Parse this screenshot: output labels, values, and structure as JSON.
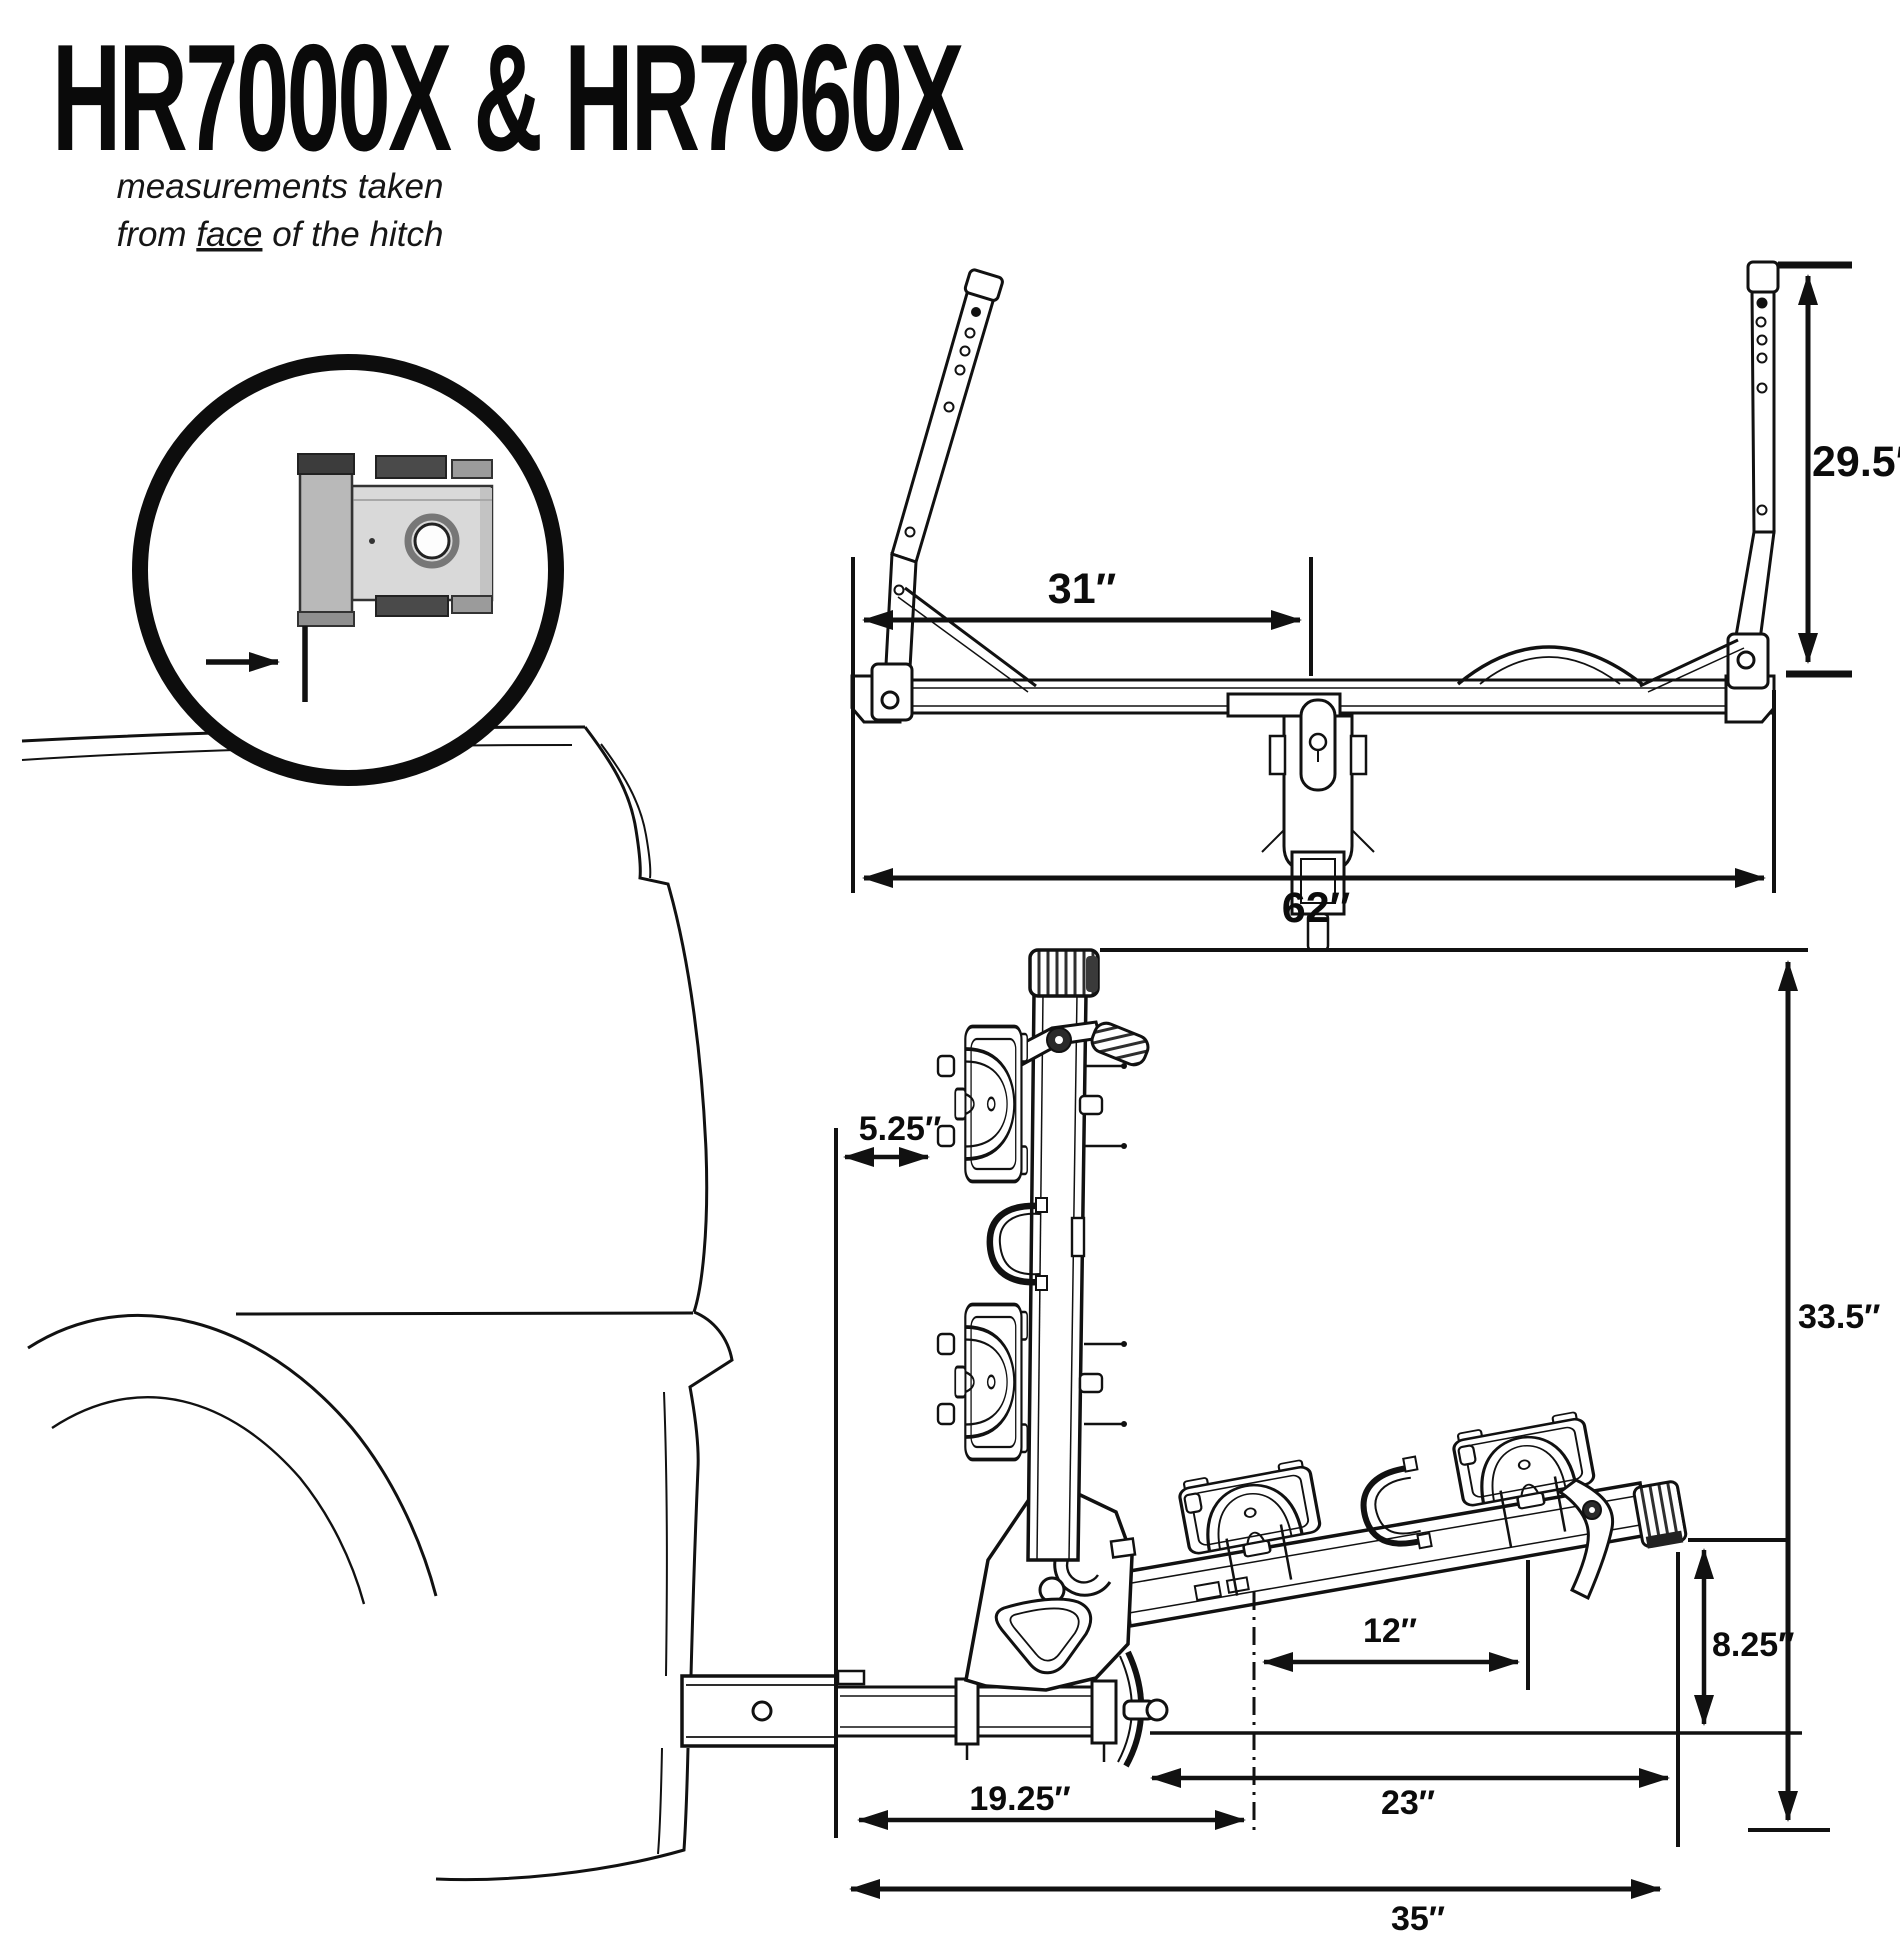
{
  "title": "HR7000X & HR7060X",
  "note": {
    "line1": "measurements taken",
    "line2_pre": "from ",
    "line2_face": "face",
    "line2_post": " of the hitch"
  },
  "dims": {
    "front_inner_width": "31″",
    "front_upright_height": "29.5″",
    "front_overall_width": "62″",
    "side_face_to_mast": "5.25″",
    "side_overall_height": "33.5″",
    "side_tray_spacing": "12″",
    "side_arm_end_height": "8.25″",
    "side_face_to_pivot": "19.25″",
    "side_pivot_to_arm_end": "23″",
    "side_overall_length": "35″"
  },
  "colors": {
    "line": "#111111",
    "metal_light": "#d9d9d9",
    "metal_mid": "#b9b9b9",
    "metal_dark": "#4a4a4a",
    "background": "#ffffff"
  }
}
